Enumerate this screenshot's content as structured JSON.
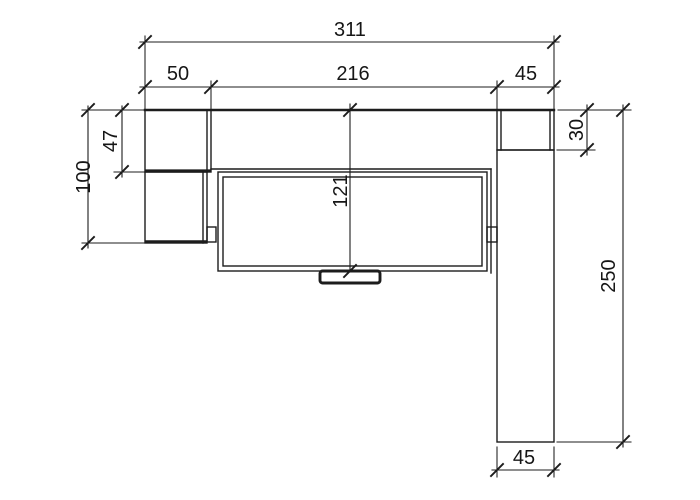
{
  "drawing": {
    "type": "technical-dimension-drawing",
    "view": "front-elevation-section",
    "background": "#ffffff",
    "line_color": "#1c1c1c",
    "units_shown": "mm (implied, unlabeled)"
  },
  "dimensions": {
    "top": {
      "total_width": "311",
      "left_section_width": "50",
      "center_section_width": "216",
      "right_section_width": "45"
    },
    "left": {
      "upper_panel_height": "47",
      "left_assembly_height": "100"
    },
    "center": {
      "front_height": "121"
    },
    "right": {
      "top_panel_height": "30",
      "total_height": "250"
    },
    "bottom": {
      "right_panel_width": "45"
    }
  }
}
